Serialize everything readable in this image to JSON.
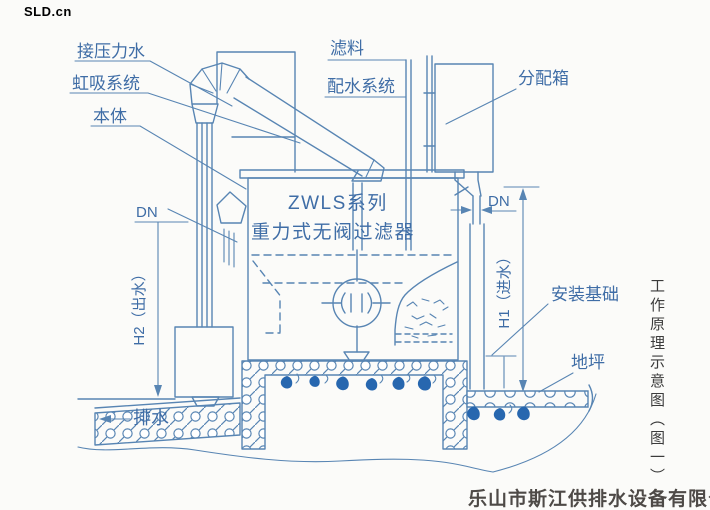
{
  "colors": {
    "diagram_line": "#5885b3",
    "diagram_label": "#3f6da6",
    "water_drip": "#2767af",
    "title_text": "#3b3b3b",
    "company_text": "#4e4a47",
    "page_background": "#fbfbf9"
  },
  "watermark": {
    "text": "SLD.cn"
  },
  "labels": {
    "pressure_water": "接压力水",
    "siphon_system": "虹吸系统",
    "body": "本体",
    "dn": "DN",
    "h2_outlet": "H2（出水）",
    "drain_water": "排水",
    "filter_media": "滤料",
    "water_distribution_system": "配水系统",
    "distribution_box": "分配箱",
    "product_series": "ZWLS系列",
    "product_name": "重力式无阀过滤器",
    "h1_inlet": "H1（进水）",
    "installation_foundation": "安装基础",
    "ground_level": "地坪"
  },
  "title": {
    "vertical_caption": "工作原理示意图（图一）"
  },
  "footer": {
    "company_name": "乐山市斯江供排水设备有限公司"
  }
}
